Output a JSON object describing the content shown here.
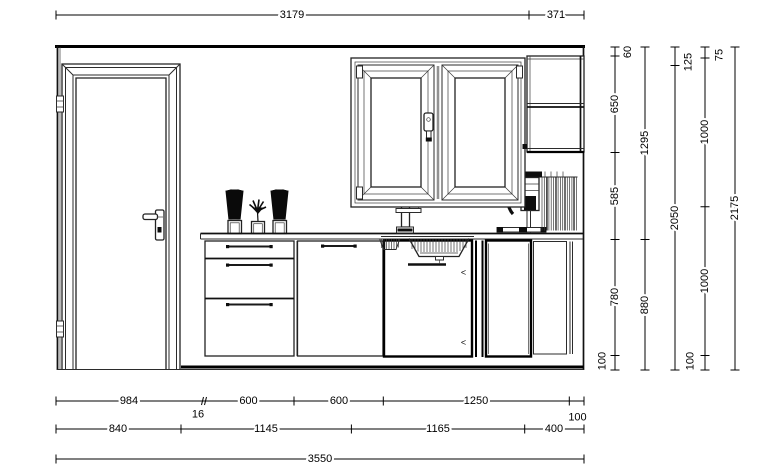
{
  "meta": {
    "drawing_type": "kitchen elevation line drawing",
    "units": "mm"
  },
  "colors": {
    "background": "#ffffff",
    "thin_line": "#2b2b2b",
    "bold_line": "#000000",
    "text": "#000000"
  },
  "dimensions": {
    "top_row": {
      "segments": [
        "3179",
        "371"
      ]
    },
    "right_chains": {
      "chain1": {
        "segments": [
          "60",
          "650",
          "585",
          "780",
          "100"
        ]
      },
      "chain2": {
        "segments": [
          "1295",
          "880"
        ]
      },
      "chain3": {
        "segments": [
          "125",
          "2050"
        ]
      },
      "chain4": {
        "segments": [
          "75",
          "1000",
          "1000",
          "100"
        ]
      },
      "chain5": {
        "segments": [
          "2175"
        ]
      }
    },
    "bottom_rows": {
      "row1": {
        "segments": [
          "984",
          "16",
          "600",
          "600",
          "1250",
          "100"
        ]
      },
      "row2": {
        "segments": [
          "840",
          "1145",
          "1165",
          "400"
        ]
      },
      "row3": {
        "segments": [
          "3550"
        ]
      }
    }
  },
  "annotations": {
    "dishwasher_marks": [
      "<",
      "<"
    ]
  }
}
